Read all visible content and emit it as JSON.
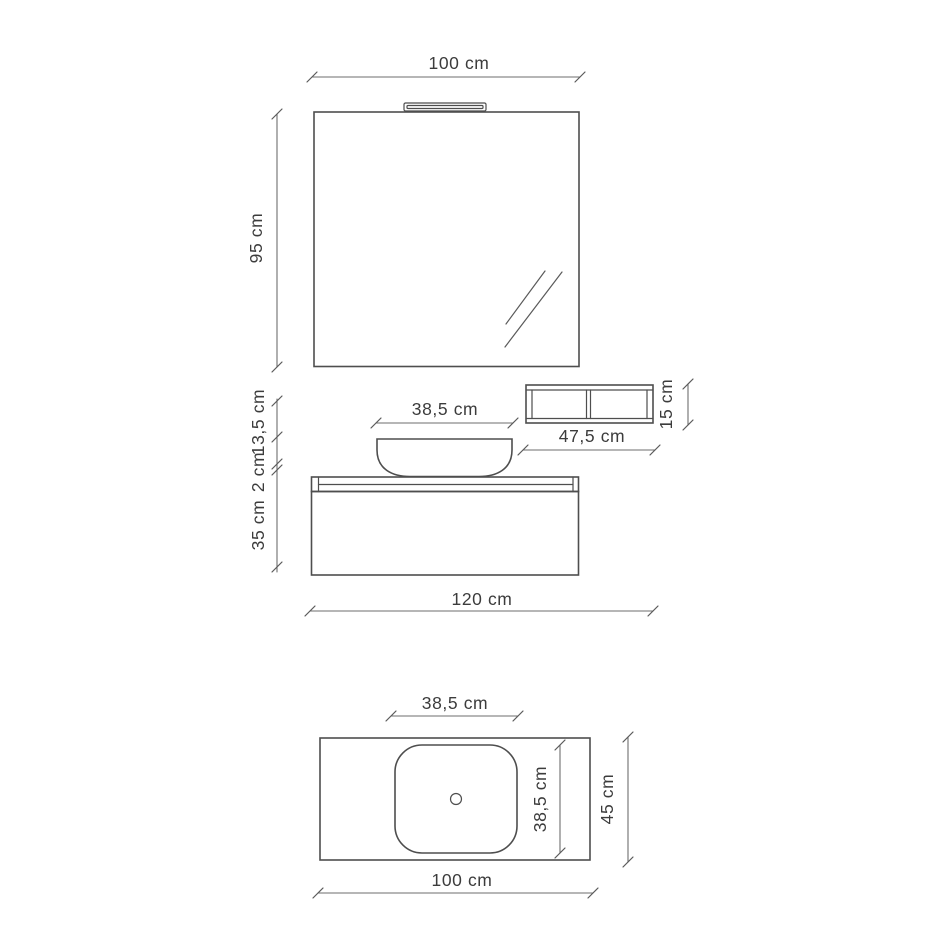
{
  "title": "Bathroom vanity set technical drawing",
  "front_view": {
    "mirror_width_label": "100 cm",
    "mirror_height_label": "95 cm",
    "basin_width_label": "38,5 cm",
    "shelf_width_label": "47,5 cm",
    "shelf_height_label": "15 cm",
    "basin_height_label": "13,5 cm",
    "countertop_thickness_label": "2 cm",
    "cabinet_height_label": "35 cm",
    "total_width_label": "120 cm"
  },
  "top_view": {
    "basin_width_label": "38,5 cm",
    "basin_depth_label": "38,5 cm",
    "counter_depth_label": "45 cm",
    "counter_width_label": "100 cm"
  },
  "colors": {
    "object_line": "#4e4e4e",
    "dimension_line": "#6e6e6e",
    "label_text": "#3c3c3c",
    "background": "#ffffff"
  }
}
